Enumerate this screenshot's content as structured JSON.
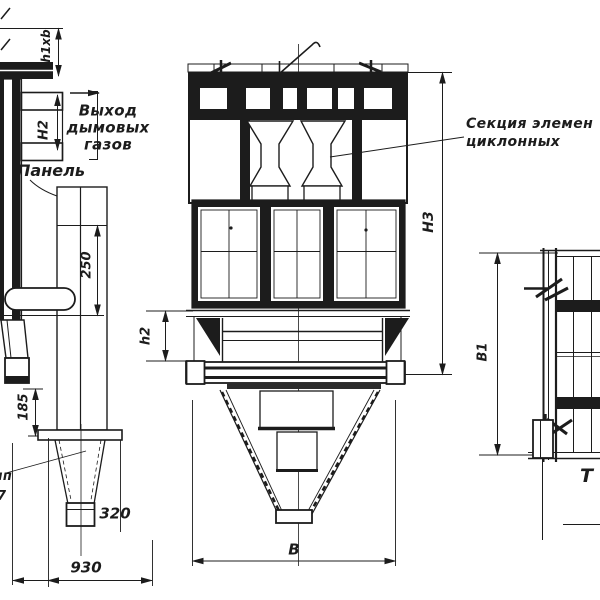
{
  "colors": {
    "line": "#1c1c1c",
    "background": "#ffffff"
  },
  "annotations": {
    "gas_outlet_line1": "Выход",
    "gas_outlet_line2": "дымовых",
    "gas_outlet_line3": "газов",
    "panel_label": "Панель",
    "cyclone_section_line1": "Секция элемен",
    "cyclone_section_line2": "циклонных",
    "left_edge_fragment_top": "чп",
    "left_edge_fragment_bottom": "7",
    "right_edge_fragment": "Т"
  },
  "dimensions": {
    "duct_size": "h1xb",
    "duct_height": "Н2",
    "panel_offset": "250",
    "stand_height": "185",
    "outlet_width": "320",
    "hopper_width_side": "930",
    "transition_height": "h2",
    "total_height": "Н3",
    "body_width": "В",
    "body_depth": "В1"
  }
}
